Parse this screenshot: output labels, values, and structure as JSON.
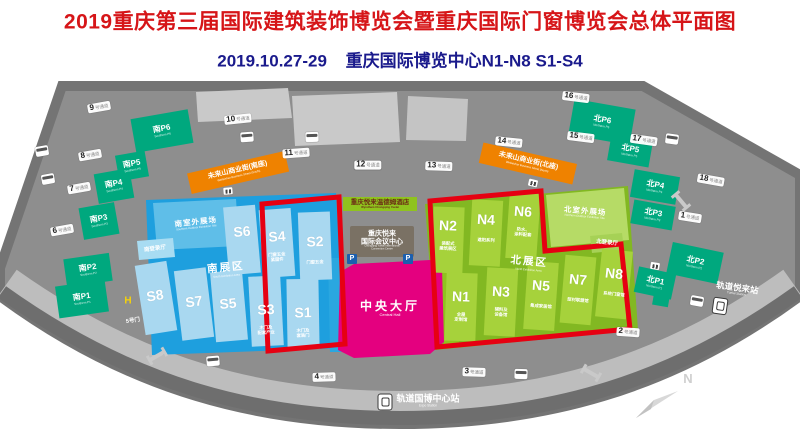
{
  "header": {
    "title": "2019重庆第三届国际建筑装饰博览会暨重庆国际门窗博览会总体平面图",
    "subtitle_date": "2019.10.27-29",
    "subtitle_venue": "重庆国际博览中心N1-N8 S1-S4"
  },
  "colors": {
    "accent_red": "#E60012",
    "title_red": "#D61518",
    "subtitle_blue": "#1A1A8C",
    "south_blue": "#1E9FDE",
    "hall_blue_light": "#A9D8F0",
    "north_green": "#82B822",
    "hall_green_light": "#A6D23B",
    "central_magenta": "#E4007F",
    "parking_teal": "#00A87E",
    "street_orange": "#EF8200",
    "road_gray": "#8E8E8E"
  },
  "map": {
    "gates": [
      {
        "id": "g1",
        "num": "1",
        "suffix": "号通道"
      },
      {
        "id": "g2",
        "num": "2",
        "suffix": "号通道"
      },
      {
        "id": "g3",
        "num": "3",
        "suffix": "号通道"
      },
      {
        "id": "g4",
        "num": "4",
        "suffix": "号通道"
      },
      {
        "id": "g5",
        "num": "5",
        "suffix": "号门",
        "plain": true
      },
      {
        "id": "g6",
        "num": "6",
        "suffix": "号通道"
      },
      {
        "id": "g7",
        "num": "7",
        "suffix": "号通道"
      },
      {
        "id": "g8",
        "num": "8",
        "suffix": "号通道"
      },
      {
        "id": "g9",
        "num": "9",
        "suffix": "号通道"
      },
      {
        "id": "g10",
        "num": "10",
        "suffix": "号通道"
      },
      {
        "id": "g11",
        "num": "11",
        "suffix": "号通道"
      },
      {
        "id": "g12",
        "num": "12",
        "suffix": "号通道"
      },
      {
        "id": "g13",
        "num": "13",
        "suffix": "号通道"
      },
      {
        "id": "g14",
        "num": "14",
        "suffix": "号通道"
      },
      {
        "id": "g15",
        "num": "15",
        "suffix": "号通道"
      },
      {
        "id": "g16",
        "num": "16",
        "suffix": "号通道"
      },
      {
        "id": "g17",
        "num": "17",
        "suffix": "号通道"
      },
      {
        "id": "g18",
        "num": "18",
        "suffix": "号通道"
      }
    ],
    "parkings": [
      {
        "id": "pS6",
        "label": "南P6",
        "sub": "Southern P6"
      },
      {
        "id": "pS5",
        "label": "南P5",
        "sub": "Southern P5"
      },
      {
        "id": "pS4",
        "label": "南P4",
        "sub": "Southern P4"
      },
      {
        "id": "pS3",
        "label": "南P3",
        "sub": "Southern P3"
      },
      {
        "id": "pS2",
        "label": "南P2",
        "sub": "Southern P2"
      },
      {
        "id": "pS1",
        "label": "南P1",
        "sub": "Southern P1"
      },
      {
        "id": "pN6",
        "label": "北P6",
        "sub": "Northern P6"
      },
      {
        "id": "pN5",
        "label": "北P5",
        "sub": "Northern P5"
      },
      {
        "id": "pN4",
        "label": "北P4",
        "sub": "Northern P4"
      },
      {
        "id": "pN3",
        "label": "北P3",
        "sub": "Northern P3"
      },
      {
        "id": "pN2",
        "label": "北P2",
        "sub": "Northern P2"
      },
      {
        "id": "pN1",
        "label": "北P1",
        "sub": "Northern P1"
      }
    ],
    "halls_south": [
      {
        "id": "S8",
        "label": "S8",
        "sub": []
      },
      {
        "id": "S7",
        "label": "S7",
        "sub": []
      },
      {
        "id": "S6",
        "label": "S6",
        "sub": []
      },
      {
        "id": "S5",
        "label": "S5",
        "sub": []
      },
      {
        "id": "S4",
        "label": "S4",
        "sub": [
          "门窗五金",
          "紧固件"
        ]
      },
      {
        "id": "S3",
        "label": "S3",
        "sub": [
          "木门及",
          "配套产业"
        ]
      },
      {
        "id": "S2",
        "label": "S2",
        "sub": [
          "门窗五金"
        ]
      },
      {
        "id": "S1",
        "label": "S1",
        "sub": [
          "木门及",
          "套装门"
        ]
      }
    ],
    "halls_north": [
      {
        "id": "N2",
        "label": "N2",
        "sub": [
          "装配式",
          "建筑展区"
        ]
      },
      {
        "id": "N4",
        "label": "N4",
        "sub": [
          "遮阳系列"
        ]
      },
      {
        "id": "N6",
        "label": "N6",
        "sub": [
          "防水、",
          "涂料配套"
        ]
      },
      {
        "id": "N1",
        "label": "N1",
        "sub": [
          "全屋",
          "定制馆"
        ]
      },
      {
        "id": "N3",
        "label": "N3",
        "sub": [
          "辅料及",
          "设备馆"
        ]
      },
      {
        "id": "N5",
        "label": "N5",
        "sub": [
          "集成家居馆"
        ]
      },
      {
        "id": "N7",
        "label": "N7",
        "sub": [
          "型材联盟馆"
        ]
      },
      {
        "id": "N8",
        "label": "N8",
        "sub": [
          "系统门窗馆"
        ]
      }
    ],
    "zones": {
      "south_zone": "南展区",
      "south_zone_en": "South Exhibition Area",
      "north_zone": "北展区",
      "north_zone_en": "North Exhibition Area",
      "south_outdoor": "南室外展场",
      "south_outdoor_en": "Southern Outdoor Exhibition Site",
      "north_outdoor": "北室外展场",
      "north_outdoor_en": "Northern Outdoor Exhibition Site",
      "south_registration": "南登录厅",
      "north_registration": "北登录厅",
      "street_south": "未来山商业街(南座)",
      "street_south_en": "Weilaishan Business Street (South)",
      "street_north": "未来山商业街(北座)",
      "street_north_en": "Weilaishan Business Street (North)"
    },
    "center": {
      "hotel": "重庆悦来温德姆酒店",
      "hotel_en": "Wyndham Chongqing Yuelai",
      "convention_line1": "重庆悦来",
      "convention_line2": "国际会议中心",
      "convention_en1": "Chongqing Yuelai International",
      "convention_en2": "Convention Center",
      "central_hall": "中央大厅",
      "central_hall_en": "Central Hall",
      "parking_icon": "P"
    },
    "stations": {
      "yuelai": "轨道悦来站",
      "yuelai_en": "Yuelai Station",
      "expo": "轨道国博中心站",
      "expo_en": "Expo Station"
    },
    "compass_n": "N",
    "heliport_h": "H"
  }
}
